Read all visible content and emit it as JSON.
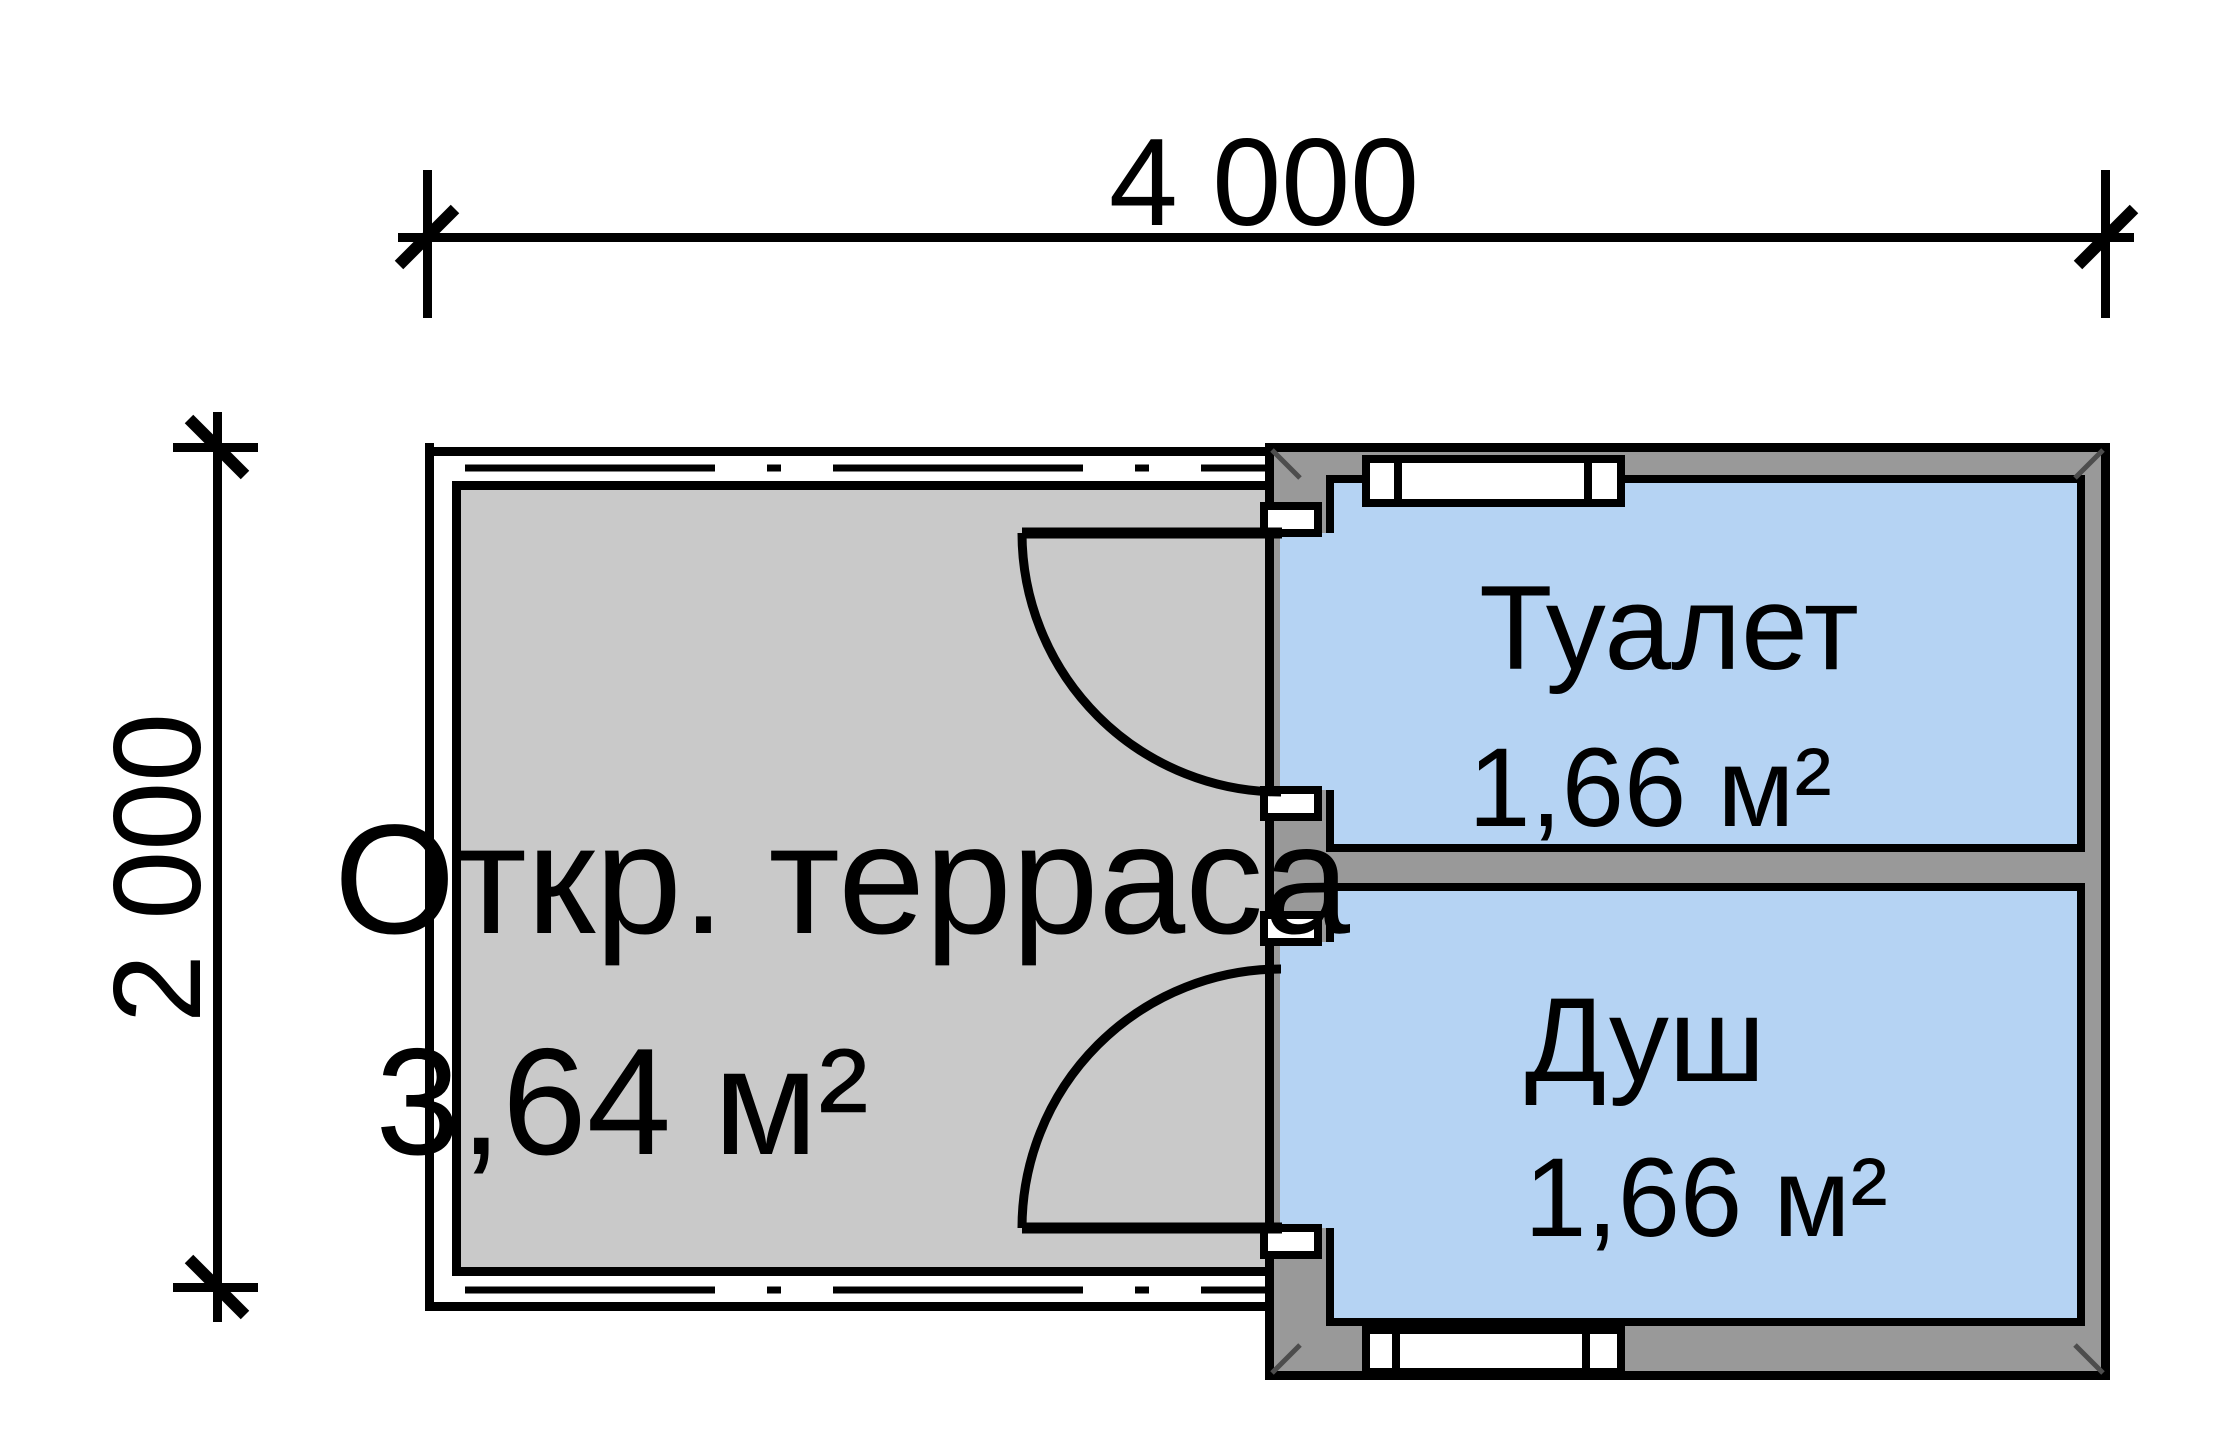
{
  "dimensions": {
    "top": "4 000",
    "left": "2 000"
  },
  "rooms": {
    "terrace": {
      "name": "Откр. терраса",
      "area": "3,64 м²"
    },
    "toilet": {
      "name": "Туалет",
      "area": "1,66 м²"
    },
    "shower": {
      "name": "Душ",
      "area": "1,66 м²"
    }
  },
  "colors": {
    "bg": "#ffffff",
    "terrace": "#c9c9c9",
    "wall": "#999999",
    "room": "#b5d3f3",
    "line": "#000000",
    "text": "#000000",
    "seam": "#4d4d4d"
  }
}
